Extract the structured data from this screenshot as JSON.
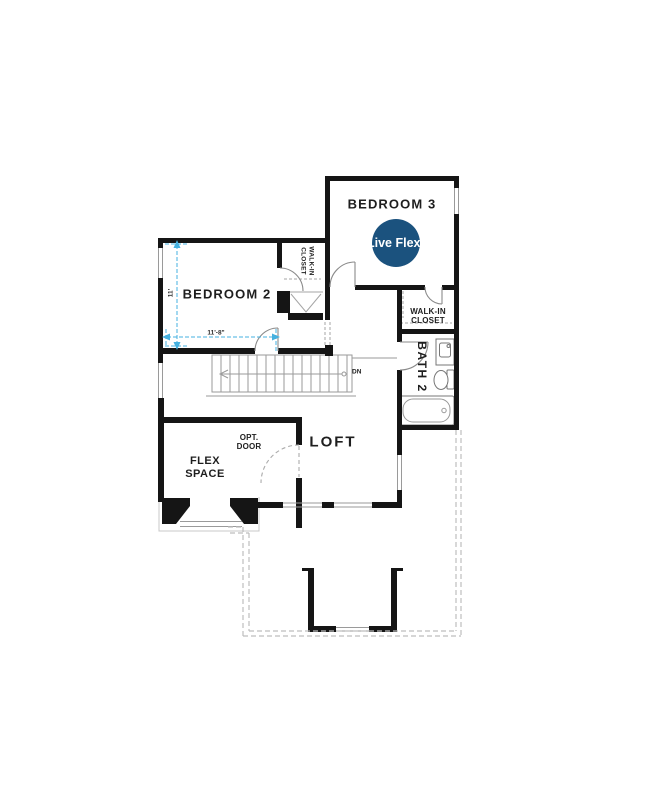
{
  "colors": {
    "badge_bg": "#1b527e",
    "badge_text": "#ffffff",
    "wall": "#151515",
    "dimension_line": "#45b1e0"
  },
  "badge": {
    "line1": "Live",
    "line2": "Flex",
    "trademark": "™"
  },
  "rooms": {
    "bedroom3": {
      "label": "BEDROOM 3"
    },
    "bedroom2": {
      "label": "BEDROOM 2"
    },
    "loft": {
      "label": "LOFT"
    },
    "flex_space": {
      "line1": "FLEX",
      "line2": "SPACE"
    },
    "bath2": {
      "label": "BATH 2"
    },
    "walkin_closet_bedroom2": {
      "line1": "WALK-IN",
      "line2": "CLOSET"
    },
    "walkin_closet_bedroom3": {
      "line1": "WALK-IN",
      "line2": "CLOSET"
    }
  },
  "annotations": {
    "stairs_down": "DN",
    "opt_door": {
      "line1": "OPT.",
      "line2": "DOOR"
    }
  },
  "dimensions": {
    "bedroom2_width": "11'-8\"",
    "bedroom2_depth": "11'"
  }
}
